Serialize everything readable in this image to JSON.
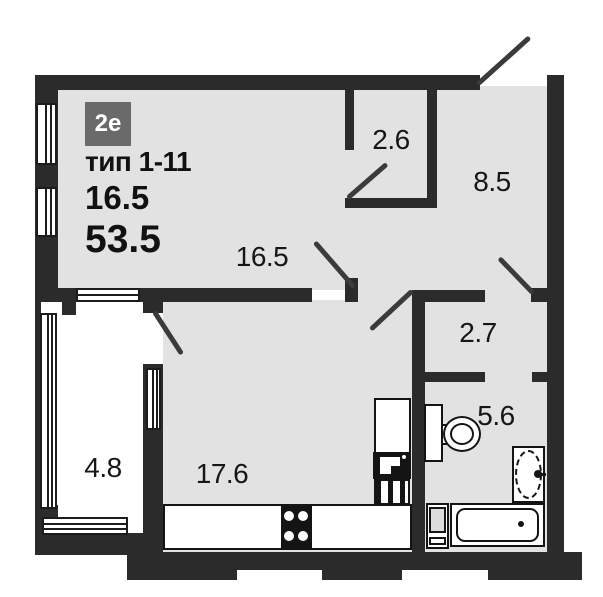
{
  "plan": {
    "badge": "2е",
    "type_label": "тип 1-11",
    "living_area": "16.5",
    "total_area": "53.5"
  },
  "labels": {
    "bedroom": "16.5",
    "wardrobe": "2.6",
    "hall": "8.5",
    "corridor": "2.7",
    "bathroom": "5.6",
    "balcony": "4.8",
    "kitchen_living": "17.6"
  },
  "colors": {
    "wall": "#2b2b2b",
    "floor": "#e2e2e2",
    "badge_bg": "#6a6a6a",
    "text": "#161616",
    "background": "#ffffff"
  }
}
